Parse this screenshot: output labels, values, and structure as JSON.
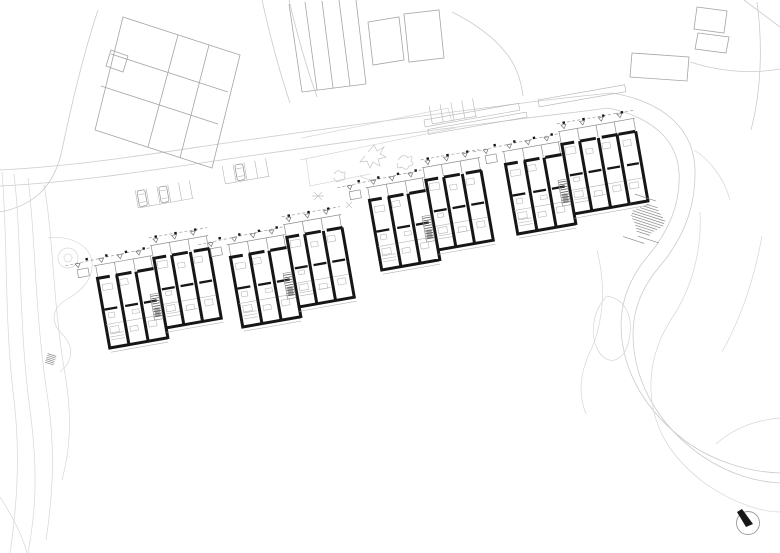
{
  "document": {
    "type": "architectural site plan",
    "view": "ground floor plan of a stepped row of terraced housing blocks with surrounding streets, parking, context buildings and terrain contours",
    "visible_text": []
  },
  "palette": {
    "bg": "#ffffff",
    "wall": "#161616",
    "ctx": "#cbcbcb",
    "bld": "#a4a4a4",
    "detail": "#b8b8b8",
    "hatch": "#5a5a5a"
  },
  "plan": {
    "housing_blocks": [
      {
        "name": "housing-block-1",
        "x": 92,
        "y": 256,
        "rotation_deg": -10,
        "units": 6
      },
      {
        "name": "housing-block-2",
        "x": 225,
        "y": 235,
        "rotation_deg": -10,
        "units": 6
      },
      {
        "name": "housing-block-3",
        "x": 364,
        "y": 178,
        "rotation_deg": -10,
        "units": 6
      },
      {
        "name": "housing-block-4",
        "x": 500,
        "y": 142,
        "rotation_deg": -10,
        "units": 7
      }
    ],
    "parking_rows": [
      {
        "name": "parking-row-west",
        "x": 138,
        "y": 206,
        "rotation_deg": -10,
        "stalls": 5,
        "cars": 2
      },
      {
        "name": "parking-row-middle",
        "x": 225,
        "y": 182,
        "rotation_deg": -10,
        "stalls": 4,
        "cars": 1
      },
      {
        "name": "parking-row-east",
        "x": 432,
        "y": 122,
        "rotation_deg": -10,
        "stalls": 4,
        "cars": 0
      }
    ],
    "context_features": [
      "context-buildings-northwest",
      "context-buildings-north",
      "context-buildings-northeast",
      "street-band-north",
      "street-loop-east",
      "terrain-contours-east",
      "terrain-contours-west",
      "garden-path-and-tree-west",
      "playground-scribbles",
      "slope-steps-east",
      "slope-steps-west"
    ],
    "north_arrow": {
      "position": "bottom-right",
      "needle_bearing": "upper-left"
    }
  }
}
